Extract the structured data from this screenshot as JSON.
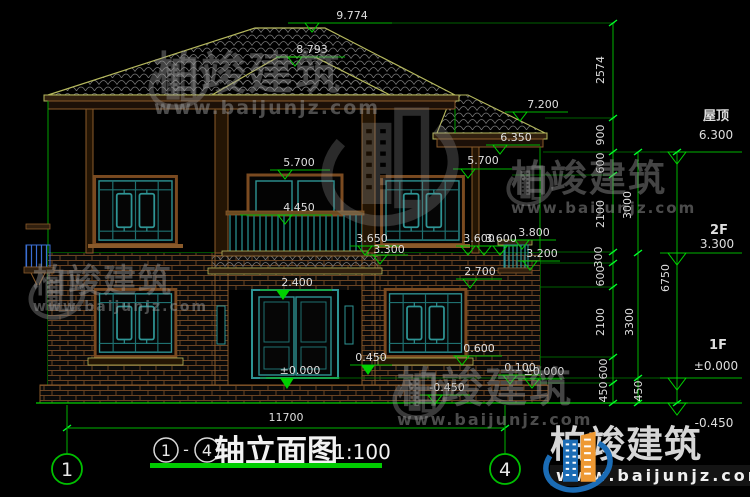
{
  "brand": {
    "name": "柏竣建筑",
    "url": "www.baijunjz.com"
  },
  "title": {
    "axis_from": "1",
    "separator": "-",
    "axis_to": "4",
    "text": "轴立面图",
    "scale": "1:100"
  },
  "axis_bubbles": {
    "left": "1",
    "right": "4"
  },
  "dims": {
    "total_width": "11700",
    "col1": [
      "2574",
      "900",
      "600",
      "2100",
      "300",
      "600",
      "2100",
      "600",
      "450"
    ],
    "col2": [
      "3000",
      "3300",
      "450"
    ],
    "col3": "6750"
  },
  "levels": {
    "roof_peak": "9.774",
    "bay_peak": "8.793",
    "eave_main": "7.200",
    "eave_wing": "6.350",
    "win2_left_top": "5.700",
    "win2_right_top": "5.700",
    "balcony_rail": "4.450",
    "canopy_edge": "3.650",
    "canopy_low": "3.300",
    "sill2_left": "3.600",
    "sill2_right": "3.600",
    "ledge_top": "3.800",
    "ledge_bottom": "3.200",
    "lintel_1f": "2.700",
    "door_top": "2.400",
    "stoop": "0.450",
    "sill1": "0.600",
    "plinth": "0.100",
    "ground_right": "±0.000",
    "ground_door": "±0.000",
    "grade": "-0.450"
  },
  "floor_marks": {
    "roof_name": "屋顶",
    "roof_level": "6.300",
    "f2_name": "2F",
    "f2_level": "3.300",
    "f1_name": "1F",
    "f1_level": "±0.000",
    "grade_level": "-0.450"
  },
  "colors": {
    "background": "#000000",
    "dim_green": "#00b400",
    "tick_green": "#00ff2a",
    "roof_olive": "#b6b95e",
    "eave_brown": "#8a5a2a",
    "window_teal": "#2e9494",
    "rail_blue": "#3b6fd4",
    "text_white": "#e0e0e0",
    "logo_blue": "#1b6cb5",
    "logo_orange": "#ee9933"
  }
}
